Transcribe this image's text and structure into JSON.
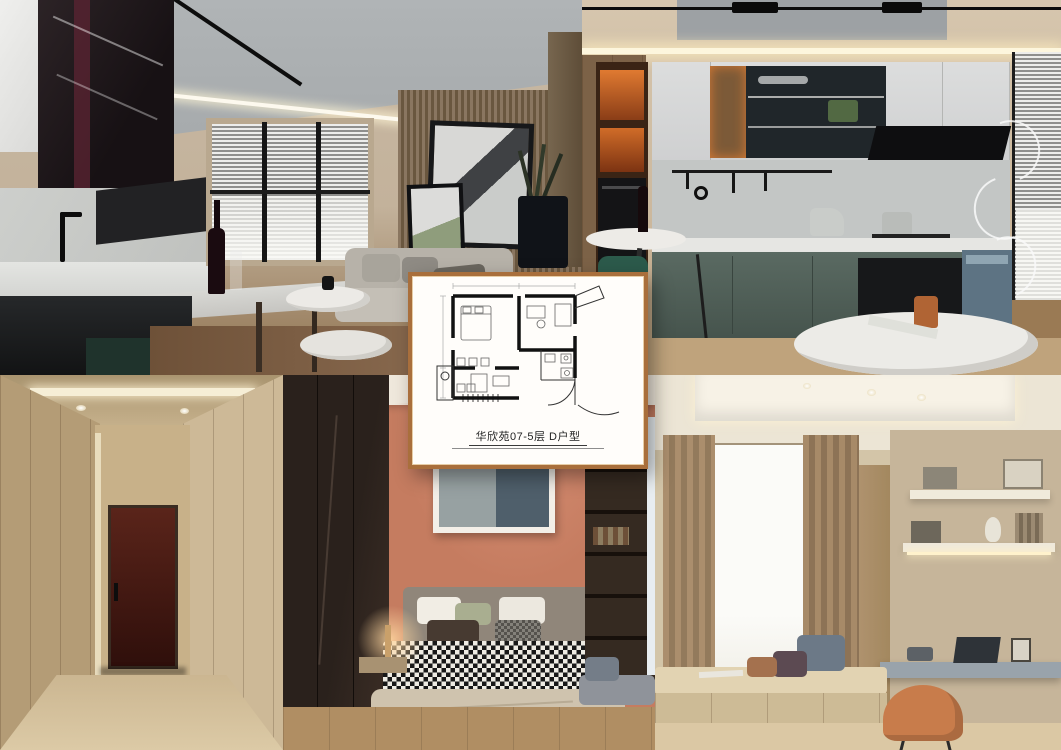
{
  "floorplan_card": {
    "caption": "华欣苑07-5层 D户型",
    "border_color": "#a96f3c",
    "background_color": "#fffdfa",
    "plan_line_color": "#111111"
  },
  "collage": {
    "layout": "five photo tiles, two rows, floor-plan card centered on top",
    "tiles": [
      {
        "name": "kitchen-living-render",
        "position": "top-left",
        "objects": [
          "white-gloss-cabinet",
          "dark-glass-cabinet",
          "black-faucet",
          "wine-bottle",
          "venetian-blind-window",
          "gray-sofa",
          "leaning-artworks",
          "wood-slat-wall",
          "plant-vase",
          "round-coffee-tables",
          "gray-ceiling-panel",
          "track-lights"
        ],
        "colors": {
          "wall": "#c3b29b",
          "cabinet": "#1d1f21",
          "ceiling_panel": "#aeb2b4",
          "floor": "#7b5b40"
        }
      },
      {
        "name": "kitchen-green-render",
        "position": "top-right",
        "objects": [
          "backlit-shelf",
          "built-in-oven",
          "bar-table",
          "green-chair",
          "white-upper-cabinets",
          "glass-display-cabinet",
          "black-range-hood",
          "utensil-rail",
          "gray-green-lower-cabinets",
          "blue-appliance-cabinet",
          "window-blinds",
          "spiral-floor-lamp",
          "round-dining-table",
          "copper-cup"
        ],
        "colors": {
          "lower_cabinets": "#5a6a62",
          "shelf_backlight": "#d97a33",
          "ceiling": "#d6c6ae"
        }
      },
      {
        "name": "hallway-render",
        "position": "bottom-left",
        "objects": [
          "wood-paneled-walls",
          "maroon-entry-door",
          "door-handle",
          "ceiling-light-slot",
          "spotlights"
        ],
        "colors": {
          "walls": "#c0a983",
          "door": "#4a1d14"
        }
      },
      {
        "name": "bedroom-render",
        "position": "bottom-middle",
        "objects": [
          "dark-wardrobe",
          "coral-accent-wall",
          "framed-artwork",
          "upholstered-headboard",
          "pillows",
          "houndstooth-blanket",
          "beige-duvet",
          "floating-nightstands",
          "warm-table-lamp",
          "round-wall-lamp",
          "built-in-bookshelf",
          "window-seat-cushion"
        ],
        "colors": {
          "accent_wall": "#c57c60",
          "blanket": "#181818",
          "wardrobe": "#2a211c"
        }
      },
      {
        "name": "study-render",
        "position": "bottom-right",
        "objects": [
          "sheer-window",
          "beige-curtains",
          "bay-window-seat",
          "throw-pillows",
          "floating-shelves",
          "decor-books",
          "floating-desk",
          "laptop",
          "photo-frame",
          "orange-chair",
          "cove-lit-ceiling",
          "spotlights"
        ],
        "colors": {
          "walls": "#d3c5a8",
          "desk": "#99a3ab",
          "chair": "#c87c4b"
        }
      }
    ]
  }
}
